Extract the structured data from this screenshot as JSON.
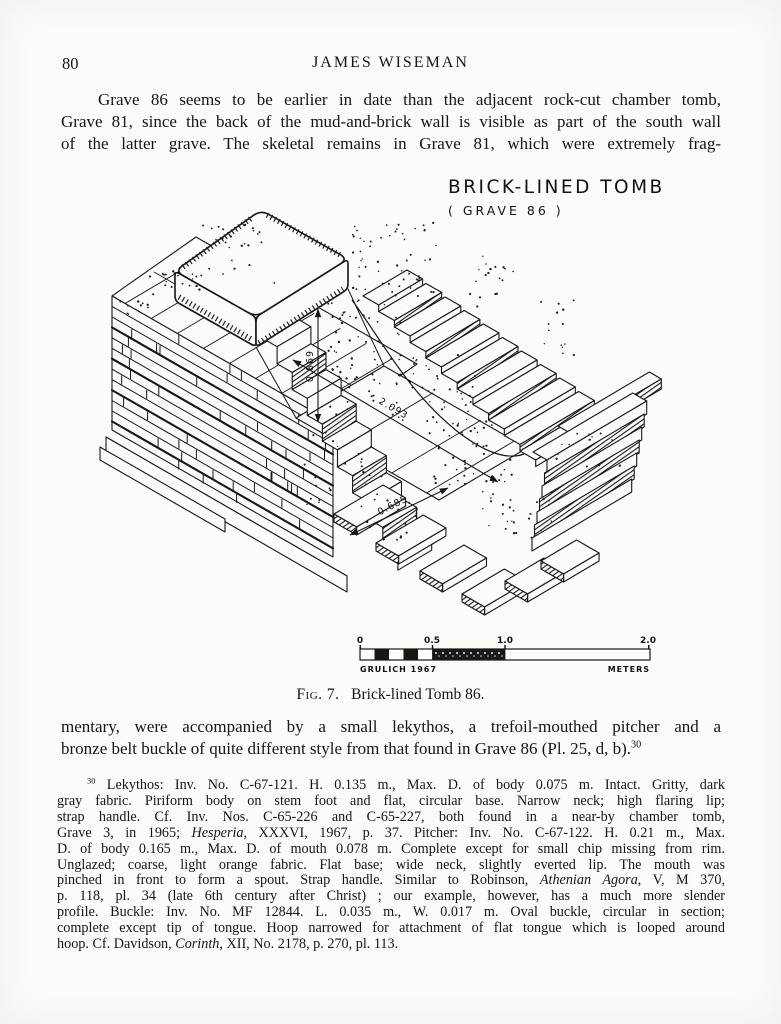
{
  "page": {
    "number": "80",
    "author": "JAMES WISEMAN"
  },
  "paragraph1": {
    "lines": [
      [
        {
          "t": "Grave 86 seems to be earlier in date than the adjacent rock-cut chamber tomb,"
        }
      ],
      [
        {
          "t": "Grave 81, since the back of the mud-and-brick wall is visible as part of the south wall"
        }
      ],
      [
        {
          "t": "of the latter grave.  The skeletal remains in Grave 81, which were extremely frag-"
        }
      ]
    ]
  },
  "paragraph2": {
    "lines": [
      [
        {
          "t": "mentary, were accompanied by a small lekythos, a trefoil-mouthed pitcher and a"
        }
      ],
      [
        {
          "t": "bronze belt buckle of quite different style from that found in Grave 86 (Pl. 25, d, b)."
        },
        {
          "t": "30",
          "sup": true
        }
      ]
    ]
  },
  "figure": {
    "title": "BRICK-LINED TOMB",
    "subtitle": "( GRAVE 86 )",
    "dim_depth": "0.869",
    "dim_length": "2.093",
    "dim_width": "0.685",
    "scale": {
      "ticks": [
        "0",
        "0.5",
        "1.0",
        "2.0"
      ],
      "credit": "GRULICH 1967",
      "unit": "METERS"
    }
  },
  "caption": {
    "figlabel": "Fig. 7.",
    "text": "Brick-lined Tomb 86."
  },
  "footnote": {
    "lines": [
      [
        {
          "t": "30",
          "sup": true
        },
        {
          "t": " Lekythos: Inv. No. C-67-121.  H. 0.135 m., Max. D. of body 0.075 m.  Intact.  Gritty, dark"
        }
      ],
      [
        {
          "t": "gray fabric.  Piriform body on stem foot and flat, circular base.  Narrow neck; high flaring lip;"
        }
      ],
      [
        {
          "t": "strap handle.  Cf. Inv. Nos. C-65-226 and C-65-227, both found in a near-by chamber tomb,"
        }
      ],
      [
        {
          "t": "Grave 3, in 1965; "
        },
        {
          "t": "Hesperia",
          "i": true
        },
        {
          "t": ", XXXVI, 1967, p. 37.  Pitcher:  Inv. No. C-67-122.  H. 0.21 m., Max."
        }
      ],
      [
        {
          "t": "D. of body 0.165 m., Max. D. of mouth 0.078 m.  Complete except for small chip missing from rim."
        }
      ],
      [
        {
          "t": "Unglazed; coarse, light orange fabric.  Flat base; wide neck, slightly everted lip.  The mouth was"
        }
      ],
      [
        {
          "t": "pinched in front to form a spout.  Strap handle.  Similar to Robinson, "
        },
        {
          "t": "Athenian Agora",
          "i": true
        },
        {
          "t": ", V, M 370,"
        }
      ],
      [
        {
          "t": "p. 118, pl. 34 (late 6th century after Christ) ; our example, however, has a much more slender"
        }
      ],
      [
        {
          "t": "profile.  Buckle:  Inv. No. MF 12844.  L. 0.035 m., W. 0.017 m.  Oval buckle, circular in section;"
        }
      ],
      [
        {
          "t": "complete except tip of tongue.  Hoop narrowed for attachment of flat tongue which is looped around"
        }
      ],
      [
        {
          "t": "hoop.  Cf. Davidson, "
        },
        {
          "t": "Corinth",
          "i": true
        },
        {
          "t": ", XII, No. 2178, p. 270, pl. 113."
        }
      ]
    ]
  }
}
